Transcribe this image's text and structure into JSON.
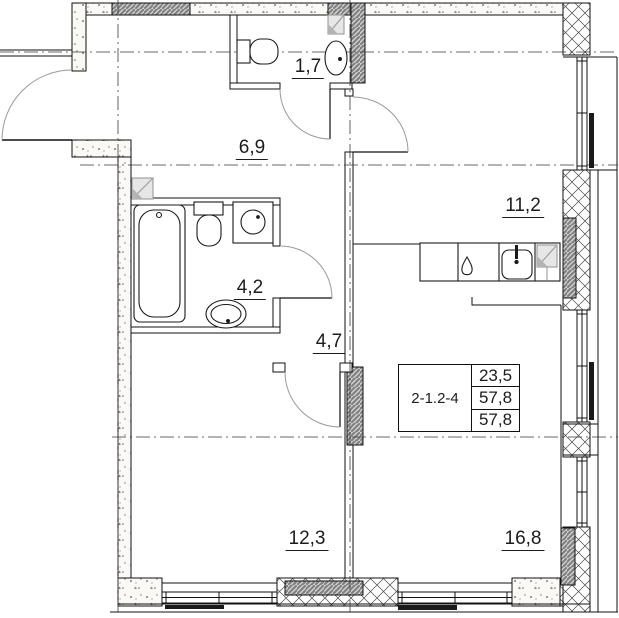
{
  "plan": {
    "apartment_label": "2-1.2-4",
    "info_table": {
      "row1": "23,5",
      "row2": "57,8",
      "row3": "57,8"
    },
    "rooms": [
      {
        "id": "wc",
        "area": "1,7"
      },
      {
        "id": "hallway",
        "area": "6,9"
      },
      {
        "id": "kitchen-living",
        "area": "11,2"
      },
      {
        "id": "bathroom",
        "area": "4,2"
      },
      {
        "id": "corridor",
        "area": "4,7"
      },
      {
        "id": "bedroom",
        "area": "12,3"
      },
      {
        "id": "living-room",
        "area": "16,8"
      }
    ],
    "fixture_icons": [
      "bathtub-icon",
      "toilet-icon",
      "washing-machine-icon",
      "sink-icon",
      "wc-toilet-icon",
      "wc-sink-icon",
      "kitchen-sink-icon",
      "gas-burner-icon",
      "vent-shaft-icon"
    ],
    "colors": {
      "background": "#ffffff",
      "line": "#111111",
      "hatch_grey": "#d2d2d2",
      "hatch_line": "#818181",
      "door_arc": "#9a9a9a",
      "vent_grey": "#9a9a9a",
      "dark_fill": "#1a1a1a"
    }
  }
}
